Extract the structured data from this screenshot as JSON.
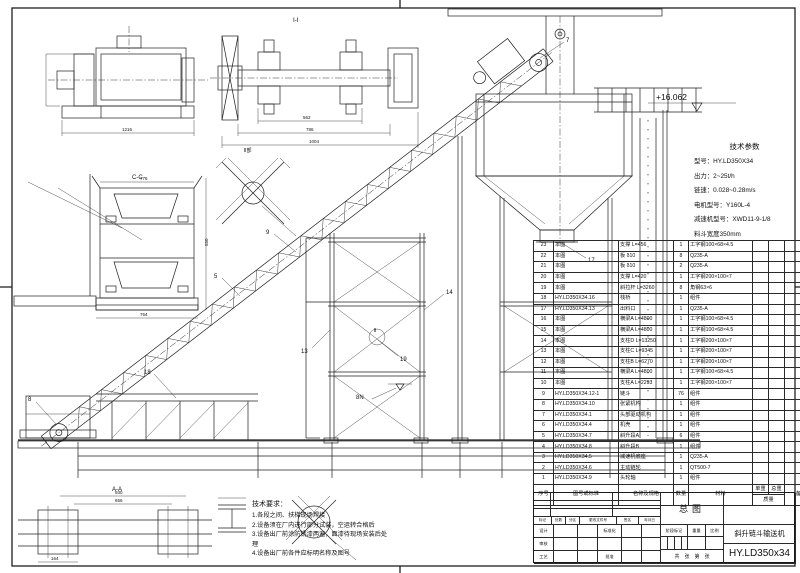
{
  "tech_params": {
    "title": "技术参数",
    "lines": [
      "型号：HY.LD350X34",
      "出力：2~25t/h",
      "链速：0.028~0.28m/s",
      "电机型号：Y160L-4",
      "减速机型号：XWD11-9-1/8",
      "料斗宽度350mm"
    ]
  },
  "tech_requirements": {
    "title": "技术要求：",
    "lines": [
      "1.各段之间、扶梯现场焊接",
      "2.设备须在厂内进行部分试装，空运转合格后",
      "3.设备出厂前涂防锈漆两遍，面漆待现场安装后处",
      "理",
      "4.设备出厂前各件应标明名称及图号"
    ]
  },
  "parts_list": {
    "col_no": "序号",
    "col_dwg": "图号或标准",
    "col_name": "名称及规格",
    "col_qty": "数量",
    "col_mat": "材料",
    "col_unit_weight": "单重",
    "col_total_weight": "总重",
    "col_weight_group": "质量",
    "col_note": "备注",
    "rows": [
      {
        "no": "23",
        "dwg": "本图",
        "name": "支撑 L=456",
        "qty": "1",
        "mat": "工字钢100×68×4.5"
      },
      {
        "no": "22",
        "dwg": "本图",
        "name": "板 δ10",
        "qty": "8",
        "mat": "Q235-A"
      },
      {
        "no": "21",
        "dwg": "本图",
        "name": "板 δ10",
        "qty": "2",
        "mat": "Q235-A"
      },
      {
        "no": "20",
        "dwg": "本图",
        "name": "支撑 L=420",
        "qty": "1",
        "mat": "工字钢200×100×7"
      },
      {
        "no": "19",
        "dwg": "本图",
        "name": "斜拉杆 L=3260",
        "qty": "8",
        "mat": "角钢63×6"
      },
      {
        "no": "18",
        "dwg": "HY.LD350X34.16",
        "name": "栈桥",
        "qty": "1",
        "mat": "组件"
      },
      {
        "no": "17",
        "dwg": "HY.LD350X34.13",
        "name": "出料口",
        "qty": "1",
        "mat": "Q235-A"
      },
      {
        "no": "16",
        "dwg": "本图",
        "name": "横梁A L=4800",
        "qty": "1",
        "mat": "工字钢100×68×4.5"
      },
      {
        "no": "15",
        "dwg": "本图",
        "name": "横梁A L=4800",
        "qty": "1",
        "mat": "工字钢100×68×4.5"
      },
      {
        "no": "14",
        "dwg": "本图",
        "name": "支柱D L=13250",
        "qty": "1",
        "mat": "工字钢200×100×7"
      },
      {
        "no": "13",
        "dwg": "本图",
        "name": "支柱C L=9345",
        "qty": "1",
        "mat": "工字钢200×100×7"
      },
      {
        "no": "12",
        "dwg": "本图",
        "name": "支柱B L=6270",
        "qty": "1",
        "mat": "工字钢200×100×7"
      },
      {
        "no": "11",
        "dwg": "本图",
        "name": "横梁A L=4800",
        "qty": "1",
        "mat": "工字钢100×68×4.5"
      },
      {
        "no": "10",
        "dwg": "本图",
        "name": "支柱A L=2293",
        "qty": "1",
        "mat": "工字钢200×100×7"
      },
      {
        "no": "9",
        "dwg": "HY.LD350X34.12-1",
        "name": "链斗",
        "qty": "76",
        "mat": "组件"
      },
      {
        "no": "8",
        "dwg": "HY.LD350X34.10",
        "name": "张紧机构",
        "qty": "1",
        "mat": "组件"
      },
      {
        "no": "7",
        "dwg": "HY.LD350X34.1",
        "name": "头部驱动机构",
        "qty": "1",
        "mat": "组件"
      },
      {
        "no": "6",
        "dwg": "HY.LD350X34.4",
        "name": "机壳",
        "qty": "1",
        "mat": "组件"
      },
      {
        "no": "5",
        "dwg": "HY.LD350X34.7",
        "name": "斜升段A",
        "qty": "6",
        "mat": "组件"
      },
      {
        "no": "4",
        "dwg": "HY.LD350X34.8",
        "name": "斜升段B",
        "qty": "1",
        "mat": "组件"
      },
      {
        "no": "3",
        "dwg": "HY.LD350X34.5",
        "name": "减速机底座",
        "qty": "1",
        "mat": "Q235-A"
      },
      {
        "no": "2",
        "dwg": "HY.LD350X34.6",
        "name": "主动链轮",
        "qty": "1",
        "mat": "QT500-7"
      },
      {
        "no": "1",
        "dwg": "HY.LD350X34.9",
        "name": "头轮轴",
        "qty": "1",
        "mat": "组件"
      }
    ]
  },
  "title_block": {
    "view_title": "总图",
    "product_name": "斜升链斗输送机",
    "drawing_no": "HY.LD350x34",
    "stage_mark_label": "阶段标记",
    "weight_label": "重量",
    "scale_label": "比例",
    "sheet_label": "共　张　第　张",
    "rev_labels": [
      "标记",
      "处数",
      "分区",
      "更改文件号",
      "签名",
      "年月日"
    ],
    "design_label": "设计",
    "standard_label": "标准化",
    "check_label": "审核",
    "process_label": "工艺",
    "approve_label": "批准"
  },
  "drawing": {
    "elevation_marker": "+16.062",
    "anchor_label": "8N",
    "view_labels": {
      "shaft_section": "Ⅰ-Ⅰ",
      "brace_detail": "Ⅱ部",
      "brace_callout": "Ⅱ",
      "trough_section": "C-C",
      "base_section": "A-A"
    },
    "dims": {
      "head": "1216",
      "shaft_1": "562",
      "shaft_2": "786",
      "shaft_3": "1004",
      "cc_top": "776",
      "cc_bottom": "764",
      "cc_side": "550",
      "aa_1": "930",
      "aa_2": "656",
      "aa_3": "164"
    },
    "balloons": {
      "b5": "5",
      "b7": "7",
      "b8": "8",
      "b9": "9",
      "b13": "13",
      "b14": "14",
      "b17": "17",
      "b18": "18",
      "b19": "19"
    }
  }
}
